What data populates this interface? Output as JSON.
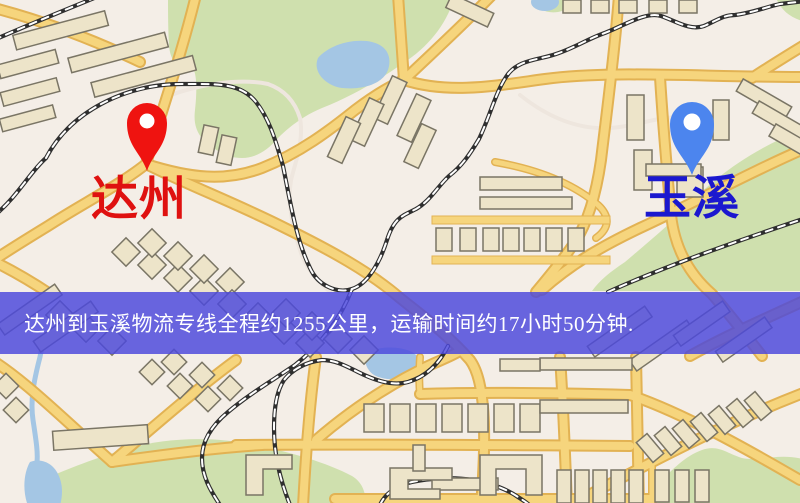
{
  "banner": {
    "text": "达州到玉溪物流专线全程约1255公里，运输时间约17小时50分钟.",
    "background_color": "#4c48dc",
    "text_color": "#ffffff"
  },
  "markers": [
    {
      "id": "dazhou",
      "label": "达州",
      "pin_color": "#ef1310",
      "label_color": "#df1110"
    },
    {
      "id": "yuxi",
      "label": "玉溪",
      "pin_color": "#4c85ee",
      "label_color": "#1b18cf"
    }
  ],
  "map": {
    "type": "street-map",
    "colors": {
      "background": "#f4eee7",
      "park": "#cfe0ae",
      "water": "#a4c6e4",
      "road_major": "#f6d57d",
      "road_casing": "#e2b253",
      "railway": "#2f2f2f",
      "building": "#ede4c9",
      "building_outline": "#7a7565"
    }
  }
}
